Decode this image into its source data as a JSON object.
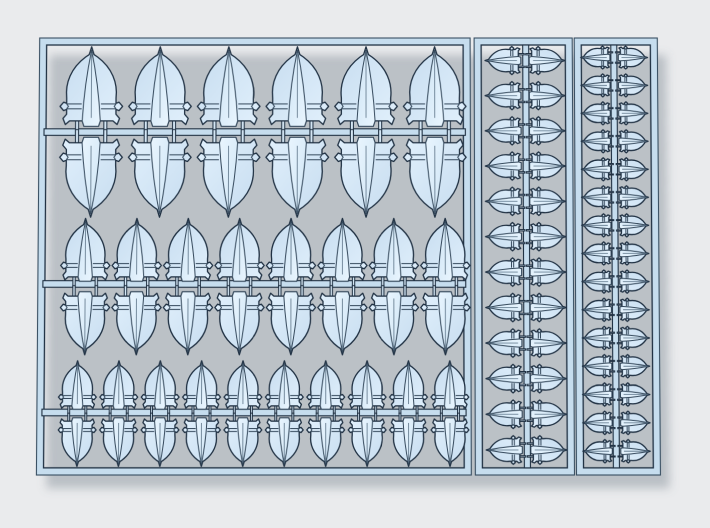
{
  "scene": {
    "description": "3D render of a light-blue plastic sprue of crusader shield bits with long cross emblems",
    "total_parts": 102
  },
  "colors": {
    "background": "#eaebed",
    "shield_light": "#e1f0fc",
    "shield_dark": "#c6dcef",
    "blade_light": "#e9f5fe",
    "blade_dark": "#cfe5f5",
    "frame_fill": "#c6ddee",
    "peg_fill": "#d4e6f4",
    "outline": "#203143",
    "outline_soft": "#3a5063",
    "detail": "#35495c",
    "crease": "#5d7488",
    "shadow": "rgba(110,122,134,0.38)"
  },
  "sprue": {
    "canvas": {
      "width": 710,
      "height": 528
    },
    "sections": [
      {
        "name": "main-panel",
        "x": 40,
        "y": 38,
        "w": 430,
        "h": 432,
        "band": 7
      },
      {
        "name": "strip-1",
        "x": 474,
        "y": 38,
        "w": 98,
        "h": 432,
        "band": 7
      },
      {
        "name": "strip-2",
        "x": 574,
        "y": 38,
        "w": 83,
        "h": 432,
        "band": 7
      }
    ],
    "runners": [
      {
        "name": "runner-top-row",
        "o": "h",
        "x": 45,
        "y": 128.5,
        "len": 420,
        "t": 6.5
      },
      {
        "name": "runner-middle-row",
        "o": "h",
        "x": 45,
        "y": 279,
        "len": 420,
        "t": 6.5
      },
      {
        "name": "runner-bottom-row",
        "o": "h",
        "x": 45,
        "y": 405.5,
        "len": 420,
        "t": 6.5
      },
      {
        "name": "runner-strip-1",
        "o": "v",
        "x": 522.5,
        "y": 45,
        "len": 418,
        "t": 6
      },
      {
        "name": "runner-strip-2",
        "o": "v",
        "x": 610.5,
        "y": 45,
        "len": 418,
        "t": 6
      }
    ],
    "shield_groups": [
      {
        "name": "large-row-top",
        "size": "large",
        "orientation": "up",
        "count": 6,
        "scale": 0.6,
        "axis_start": 92,
        "axis_step": 68.5,
        "cross_pos": 126
      },
      {
        "name": "large-row-bottom",
        "size": "large",
        "orientation": "down",
        "count": 6,
        "scale": 0.6,
        "axis_start": 92,
        "axis_step": 68.5,
        "cross_pos": 137
      },
      {
        "name": "medium-row-top",
        "size": "medium",
        "orientation": "up",
        "count": 8,
        "scale": 0.47,
        "axis_start": 87,
        "axis_step": 51.1,
        "cross_pos": 279.5
      },
      {
        "name": "medium-row-bottom",
        "size": "medium",
        "orientation": "down",
        "count": 8,
        "scale": 0.47,
        "axis_start": 87,
        "axis_step": 51.1,
        "cross_pos": 290
      },
      {
        "name": "small-row-top",
        "size": "small",
        "orientation": "up",
        "count": 10,
        "scale": 0.36,
        "axis_start": 80,
        "axis_step": 41,
        "cross_pos": 405.5
      },
      {
        "name": "small-row-bottom",
        "size": "small",
        "orientation": "down",
        "count": 10,
        "scale": 0.36,
        "axis_start": 80,
        "axis_step": 41,
        "cross_pos": 414
      },
      {
        "name": "strip1-left-column",
        "size": "strip-large",
        "orientation": "left",
        "count": 12,
        "scale": 0.27,
        "axis_start": 60.5,
        "axis_step": 35,
        "cross_pos": 520.5
      },
      {
        "name": "strip1-right-column",
        "size": "strip-large",
        "orientation": "right",
        "count": 12,
        "scale": 0.27,
        "axis_start": 60.5,
        "axis_step": 35,
        "cross_pos": 529
      },
      {
        "name": "strip2-left-column",
        "size": "strip-small",
        "orientation": "left",
        "count": 15,
        "scale": 0.22,
        "axis_start": 57.5,
        "axis_step": 27.8,
        "cross_pos": 609.5
      },
      {
        "name": "strip2-right-column",
        "size": "strip-small",
        "orientation": "right",
        "count": 15,
        "scale": 0.22,
        "axis_start": 57.5,
        "axis_step": 27.8,
        "cross_pos": 618
      }
    ],
    "part_counts": {
      "large": 12,
      "medium": 16,
      "small": 20,
      "strip_large": 24,
      "strip_small": 30,
      "total": 102
    }
  }
}
